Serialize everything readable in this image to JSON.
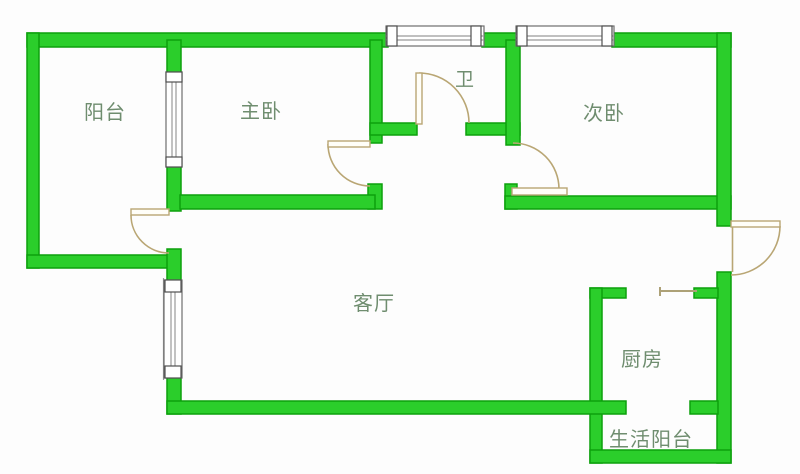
{
  "colors": {
    "wall_fill": "#2bce2b",
    "wall_border": "#0da00d",
    "door": "#b9a674",
    "window_frame": "#6e6e6e",
    "window_line": "#9a9a9a",
    "label": "#6f8d6f",
    "background": "#fdfdfd",
    "counter": "#ada177"
  },
  "rooms": {
    "balcony": {
      "label": "阳台"
    },
    "master_bedroom": {
      "label": "主卧"
    },
    "bathroom": {
      "label": "卫"
    },
    "second_bedroom": {
      "label": "次卧"
    },
    "living_room": {
      "label": "客厅"
    },
    "kitchen": {
      "label": "厨房"
    },
    "utility_balcony": {
      "label": "生活阳台"
    }
  }
}
